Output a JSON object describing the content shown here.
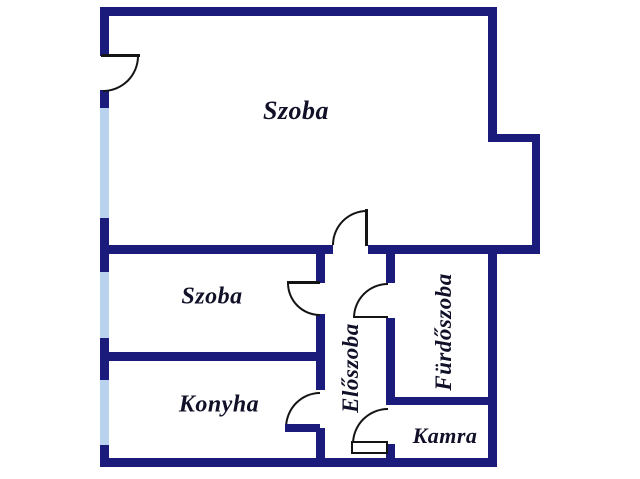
{
  "floorplan": {
    "rooms": [
      {
        "id": "szoba-1",
        "label": "Szoba"
      },
      {
        "id": "szoba-2",
        "label": "Szoba"
      },
      {
        "id": "konyha",
        "label": "Konyha"
      },
      {
        "id": "eloszoba",
        "label": "Előszoba"
      },
      {
        "id": "furdoszoba",
        "label": "Fürdőszoba"
      },
      {
        "id": "kamra",
        "label": "Kamra"
      }
    ],
    "colors": {
      "wall": "#1b1b7b",
      "window": "#b9d3ee",
      "door_arc": "#141414",
      "label": "#101028",
      "background": "#ffffff"
    }
  }
}
